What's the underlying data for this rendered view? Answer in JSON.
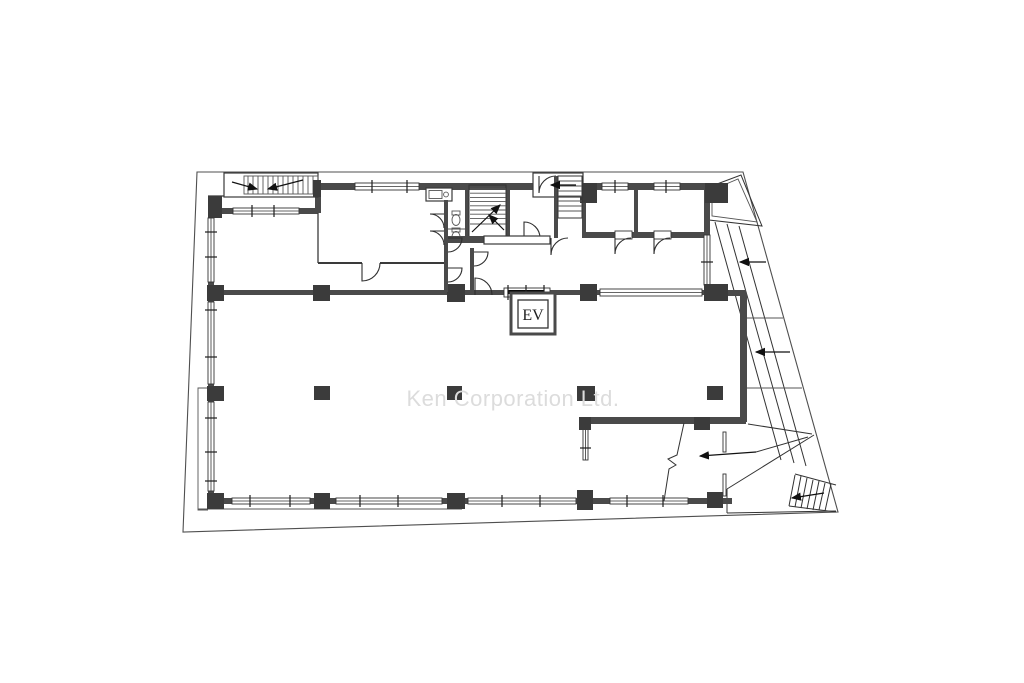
{
  "document": {
    "kind": "architectural-floor-plan",
    "watermark": "Ken Corporation Ltd.",
    "elevator_label": "EV",
    "colors": {
      "background": "#ffffff",
      "wall": "#4a4a4a",
      "column": "#3b3b3b",
      "thin_line": "#333333",
      "property_line": "#4f4f4f",
      "watermark": "#dcdcdc"
    }
  }
}
